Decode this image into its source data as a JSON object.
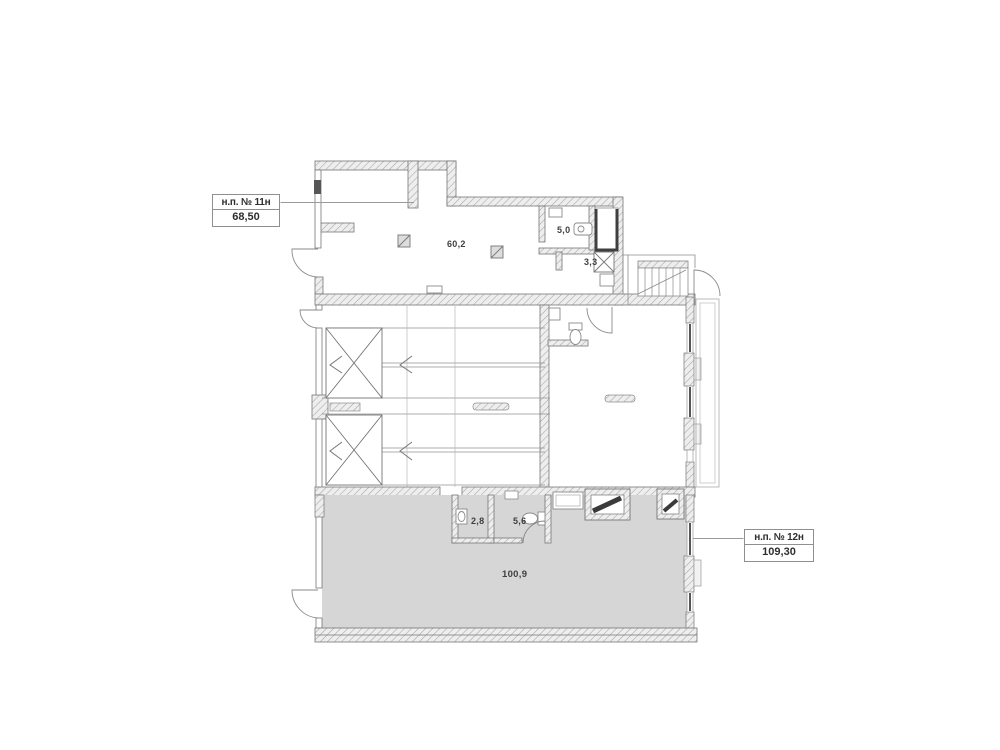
{
  "units": [
    {
      "label": "н.п. № 11н",
      "area": "68,50"
    },
    {
      "label": "н.п. № 12н",
      "area": "109,30"
    }
  ],
  "rooms": [
    {
      "id": "hall-upper",
      "area": "60,2"
    },
    {
      "id": "bathroom-upper",
      "area": "5,0"
    },
    {
      "id": "shaft-room",
      "area": "3,3"
    },
    {
      "id": "storage-lower",
      "area": "2,8"
    },
    {
      "id": "bathroom-lower",
      "area": "5,6"
    },
    {
      "id": "hall-lower",
      "area": "100,9"
    }
  ],
  "colors": {
    "background": "#ffffff",
    "wall_line": "#767676",
    "hatch_line": "#a5a5a5",
    "hatch_bg": "#eeeeee",
    "floor_gray": "#d6d6d6",
    "window_dark": "#565656",
    "thin_line": "#8c8c8c",
    "leader": "#9a9a9a",
    "text": "#3f3f3f"
  }
}
